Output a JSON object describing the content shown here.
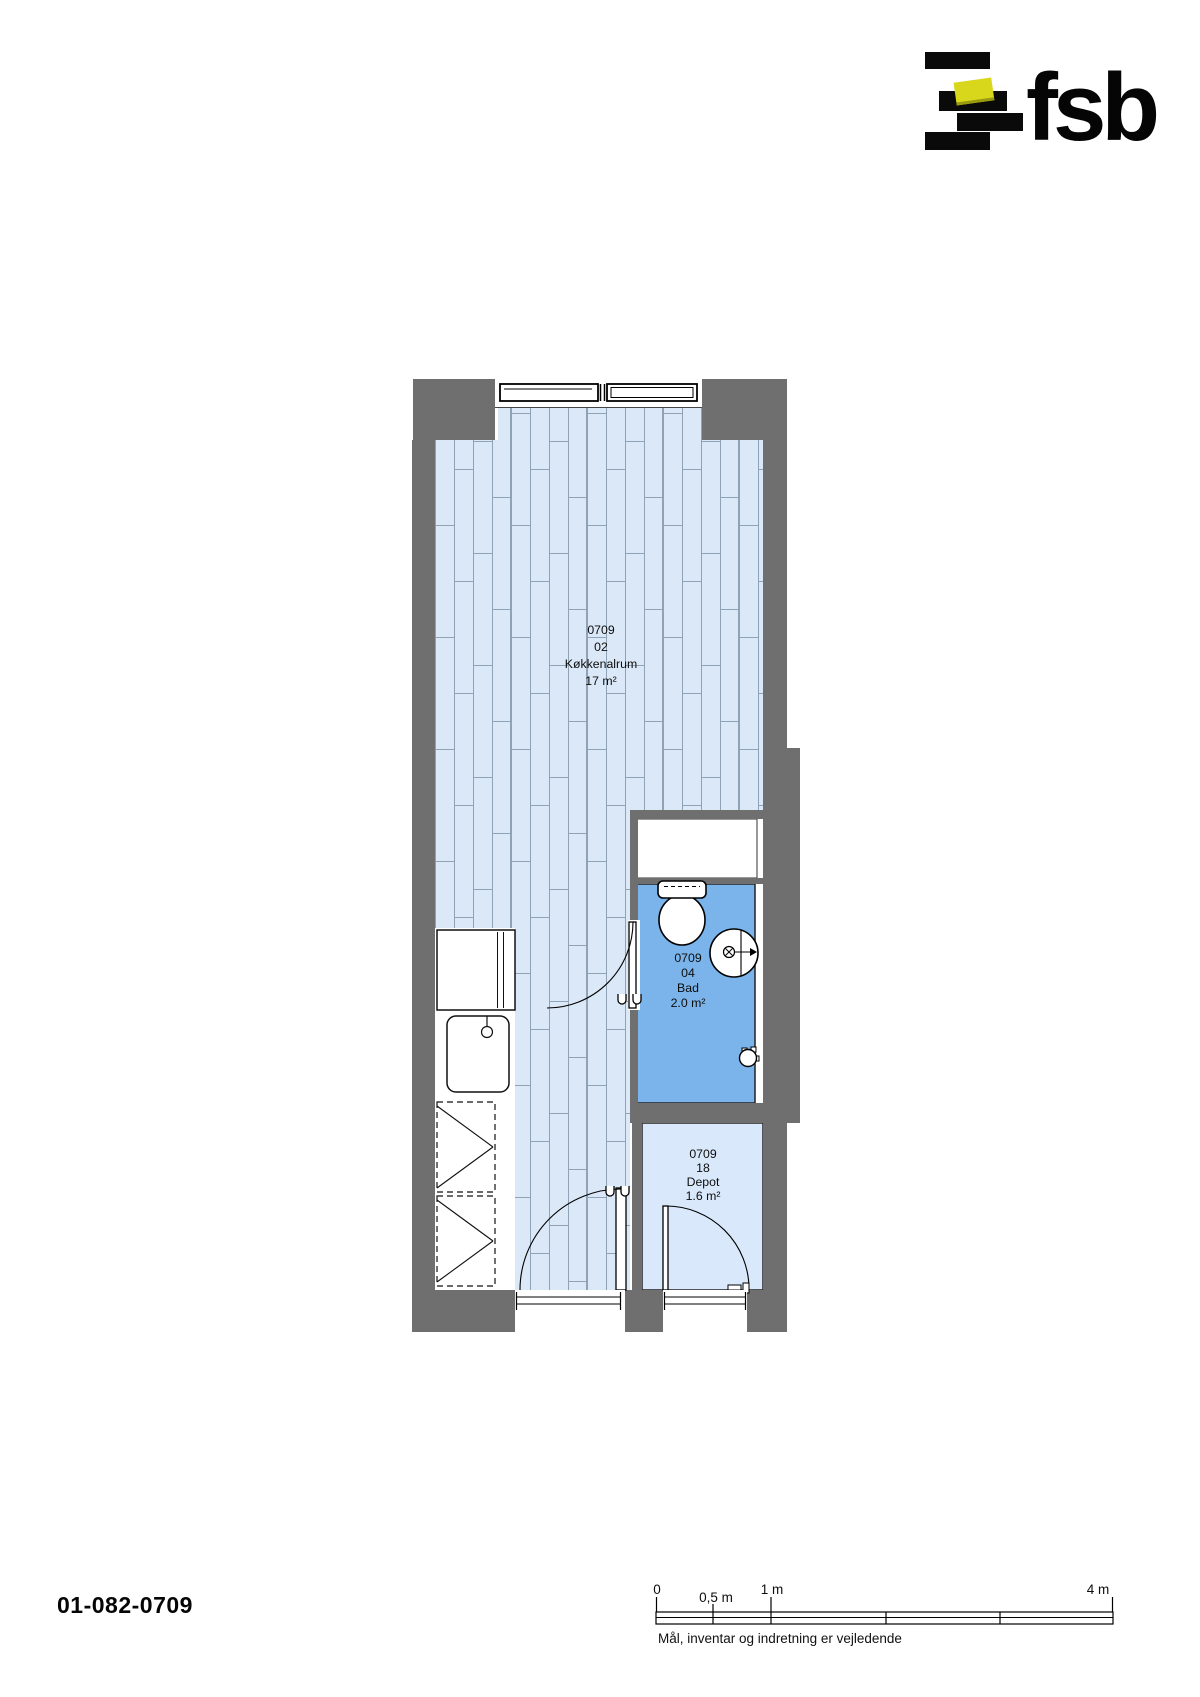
{
  "logo": {
    "brand": "fsb"
  },
  "plan": {
    "rooms": [
      {
        "unit": "0709",
        "number": "02",
        "name": "Køkkenalrum",
        "area": "17 m²"
      },
      {
        "unit": "0709",
        "number": "04",
        "name": "Bad",
        "area": "2.0 m²"
      },
      {
        "unit": "0709",
        "number": "18",
        "name": "Depot",
        "area": "1.6 m²"
      }
    ]
  },
  "footer": {
    "drawing_number": "01-082-0709",
    "disclaimer": "Mål, inventar og indretning er vejledende",
    "scale_labels": {
      "zero": "0",
      "half": "0,5 m",
      "one": "1 m",
      "four": "4 m"
    }
  },
  "colors": {
    "wall": "#6f6f6f",
    "bathroom_floor": "#7ab4ea",
    "depot_floor": "#d9e8fa",
    "plank_floor": "#dbe8f7",
    "plank_line": "#8fa2b6",
    "logo_yellow": "#d8d71c"
  }
}
